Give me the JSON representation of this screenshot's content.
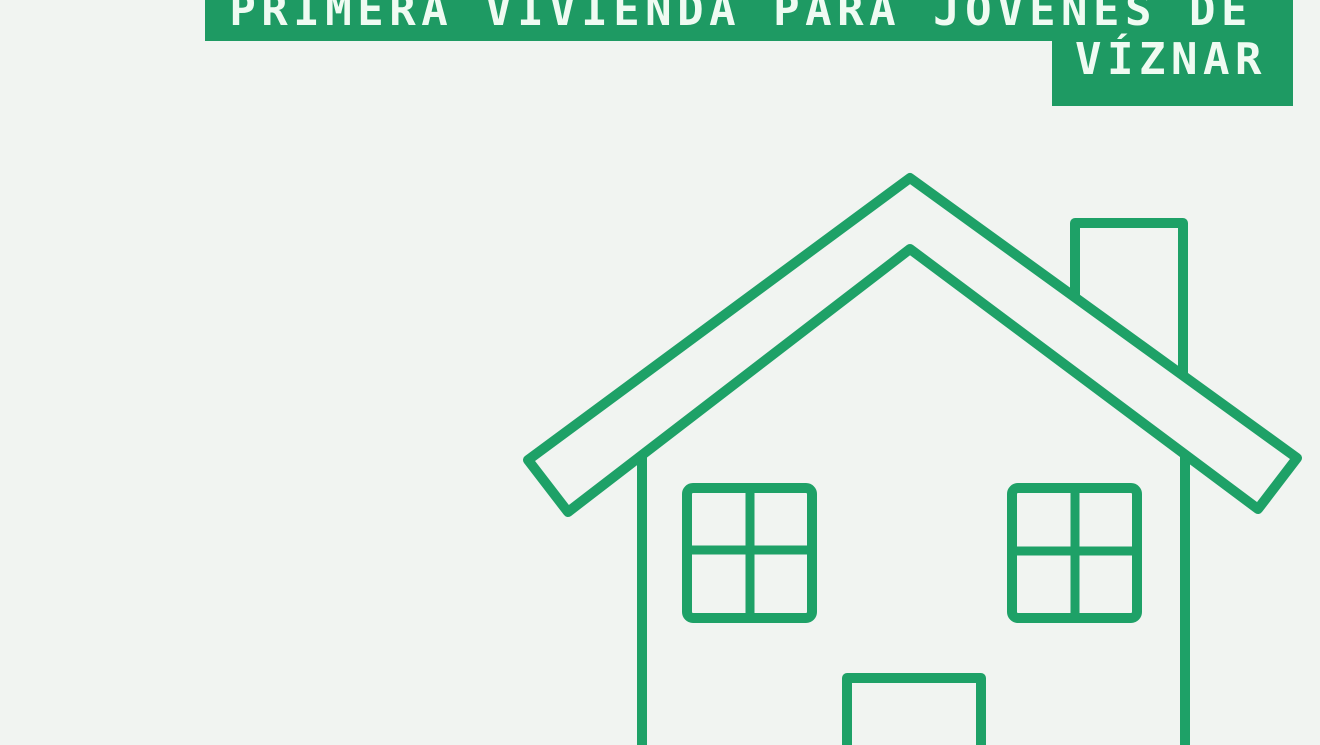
{
  "colors": {
    "background": "#f1f4f1",
    "banner_green": "#1e9a63",
    "house_green": "#1ea167",
    "banner_text": "#effbf2"
  },
  "banner": {
    "line1": "PRIMERA VIVIENDA PARA JÓVENES DE",
    "line2": "VÍZNAR"
  },
  "illustration": {
    "icon": "house-outline-icon"
  }
}
